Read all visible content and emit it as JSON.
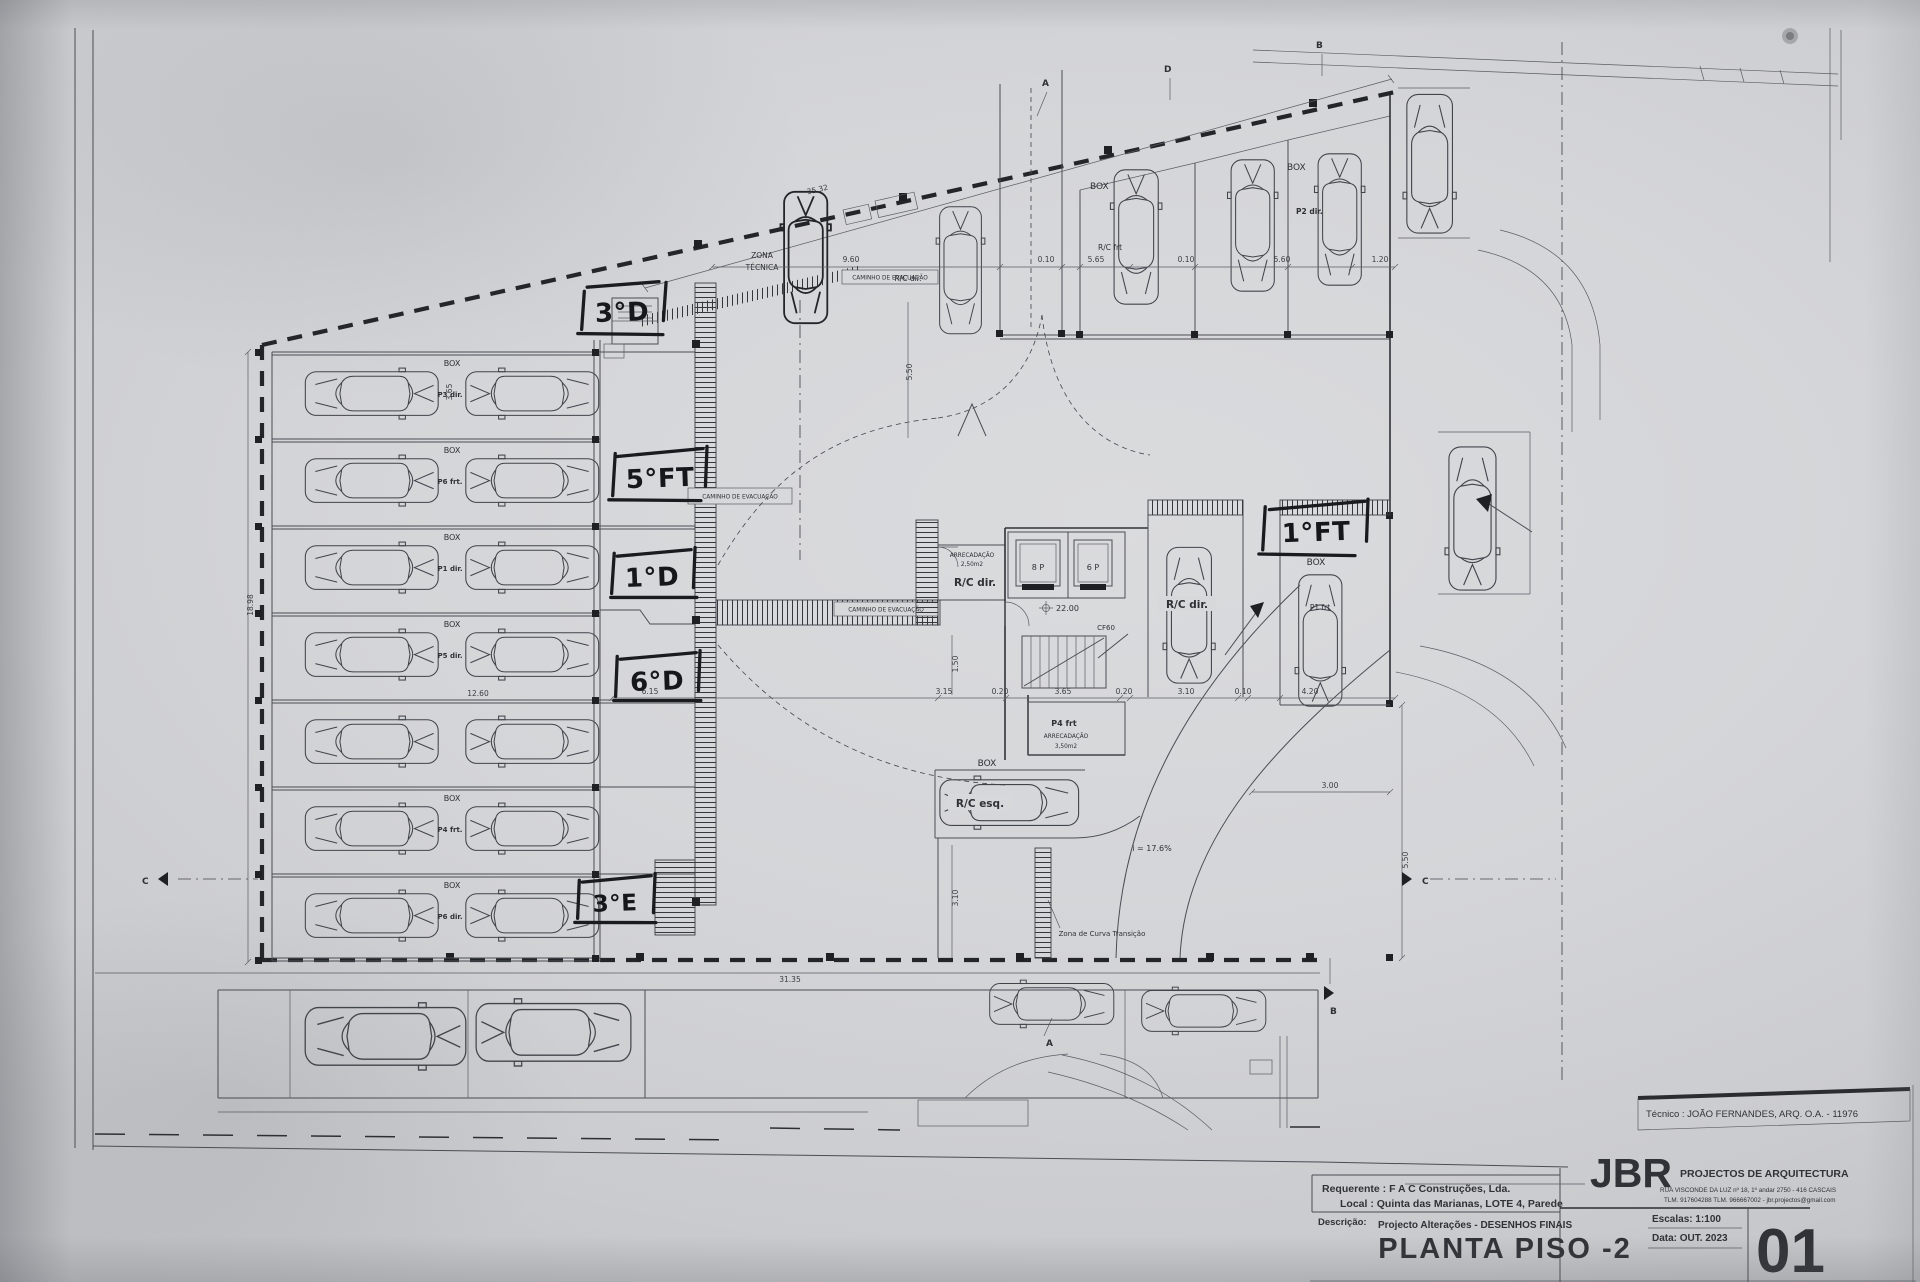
{
  "plan": {
    "labels": {
      "box": "BOX",
      "zona_tecnica_1": "ZONA",
      "zona_tecnica_2": "TÉCNICA",
      "caminho": "CAMINHO DE EVACUAÇÃO",
      "rc_dir": "R/C dir.",
      "rc_esq": "R/C esq.",
      "rc_frt": "R/C frt",
      "p2_dir": "P2 dir.",
      "p1_frt": "P1 frt",
      "p4_frt": "P4 frt",
      "arrecadacao": "ARRECADAÇÃO",
      "area_250": "2,50m2",
      "area_350": "3,50m2",
      "elev_8p": "8 P",
      "elev_6p": "6 P",
      "level": "22.00",
      "cf60": "CF60",
      "slope": "i = 17.6%",
      "zona_curva": "Zona de Curva Transição"
    },
    "left_rows": [
      {
        "box": "BOX",
        "stall": "P3 dir."
      },
      {
        "box": "BOX",
        "stall": "P6 frt."
      },
      {
        "box": "BOX",
        "stall": "P1 dir."
      },
      {
        "box": "BOX",
        "stall": "P5 dir."
      },
      {
        "box": "",
        "stall": ""
      },
      {
        "box": "BOX",
        "stall": "P4 frt."
      },
      {
        "box": "BOX",
        "stall": "P6 dir."
      }
    ],
    "handwritten": {
      "h1": "3°D",
      "h2": "5°FT",
      "h3": "1°D",
      "h4": "6°D",
      "h5": "3°E",
      "h6": "1°FT"
    },
    "dims": {
      "d35_32": "35.32",
      "d9_60": "9.60",
      "d0_10": "0.10",
      "d5_65": "5.65",
      "d5_60": "5.60",
      "d1_20": "1.20",
      "d18_98": "18.98",
      "d3_65": "3.65",
      "d12_60": "12.60",
      "d31_35": "31.35",
      "d6_15": "6.15",
      "d3_15": "3.15",
      "d0_20": "0.20",
      "d3_10": "3.10",
      "d4_20": "4.20",
      "d3_00": "3.00",
      "d5_50": "5.50",
      "d1_50": "1.50"
    },
    "markers": {
      "a": "A",
      "b": "B",
      "c": "C",
      "d": "D"
    }
  },
  "titleblock": {
    "tecnico": "Técnico : JOÃO FERNANDES, ARQ.   O.A. - 11976",
    "requerente": "Requerente : F A C  Construções, Lda.",
    "local": "Local : Quinta das Marianas, LOTE 4, Parede",
    "descricao_label": "Descrição:",
    "descricao_value": "Projecto Alterações - DESENHOS FINAIS",
    "drawing_title": "PLANTA PISO -2",
    "firm_initials": "JBR",
    "firm_name": "PROJECTOS DE ARQUITECTURA",
    "firm_address1": "RUA VISCONDE DA LUZ nº 18, 1º andar  2750 - 416  CASCAIS",
    "firm_address2": "TLM. 917604288  TLM. 966667002 - jbr.projectos@gmail.com",
    "escala": "Escalas:  1:100",
    "data": "Data: OUT.  2023",
    "sheet_number": "01"
  }
}
